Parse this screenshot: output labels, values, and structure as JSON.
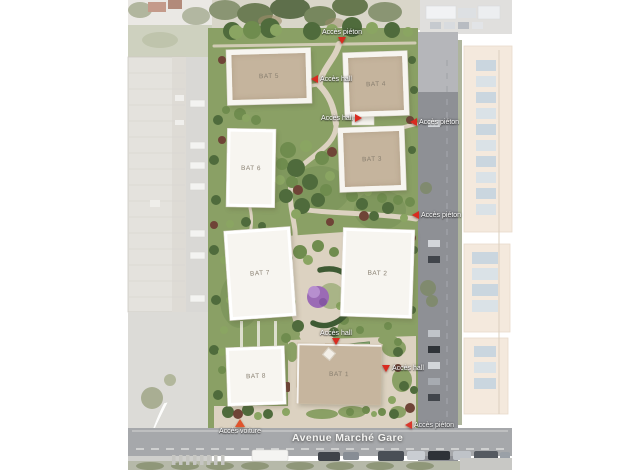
{
  "plan": {
    "type": "residential site plan (aerial render)",
    "street": {
      "name": "Avenue Marché Gare"
    }
  },
  "buildings": [
    {
      "id": "bat-5",
      "label": "BAT 5"
    },
    {
      "id": "bat-4",
      "label": "BAT 4"
    },
    {
      "id": "bat-6",
      "label": "BAT 6"
    },
    {
      "id": "bat-3",
      "label": "BAT 3"
    },
    {
      "id": "bat-7",
      "label": "BAT 7"
    },
    {
      "id": "bat-2",
      "label": "BAT 2"
    },
    {
      "id": "bat-8",
      "label": "BAT 8"
    },
    {
      "id": "bat-1",
      "label": "BAT 1"
    }
  ],
  "access_points": [
    {
      "label": "Accès piéton",
      "kind": "pedestrian",
      "marker": "pin-down",
      "position": "north"
    },
    {
      "label": "Accès hall",
      "kind": "hall",
      "marker": "triangle-left",
      "position": "between-bat5-bat4"
    },
    {
      "label": "Accès hall",
      "kind": "hall",
      "marker": "triangle-right",
      "position": "below-bat4"
    },
    {
      "label": "Accès piéton",
      "kind": "pedestrian",
      "marker": "triangle-left",
      "position": "east-upper"
    },
    {
      "label": "Accès piéton",
      "kind": "pedestrian",
      "marker": "triangle-left",
      "position": "east-mid"
    },
    {
      "label": "Accès hall",
      "kind": "hall",
      "marker": "pin-down",
      "position": "above-bat1"
    },
    {
      "label": "Accès hall",
      "kind": "hall",
      "marker": "pin-down",
      "position": "east-of-bat1"
    },
    {
      "label": "Accès voiture",
      "kind": "car",
      "marker": "triangle-up-orange",
      "position": "south-west"
    },
    {
      "label": "Accès piéton",
      "kind": "pedestrian",
      "marker": "triangle-left",
      "position": "south-east"
    }
  ],
  "colors": {
    "site_green": "#8aa065",
    "path_beige": "#dcd2c1",
    "building_white": "#f7f5f0",
    "roof_beige": "#c5b49d",
    "road_gray": "#8e9095",
    "accent_red": "#d92b20",
    "accent_orange": "#e0542c",
    "flowering_tree_purple": "#9b6bb5"
  }
}
